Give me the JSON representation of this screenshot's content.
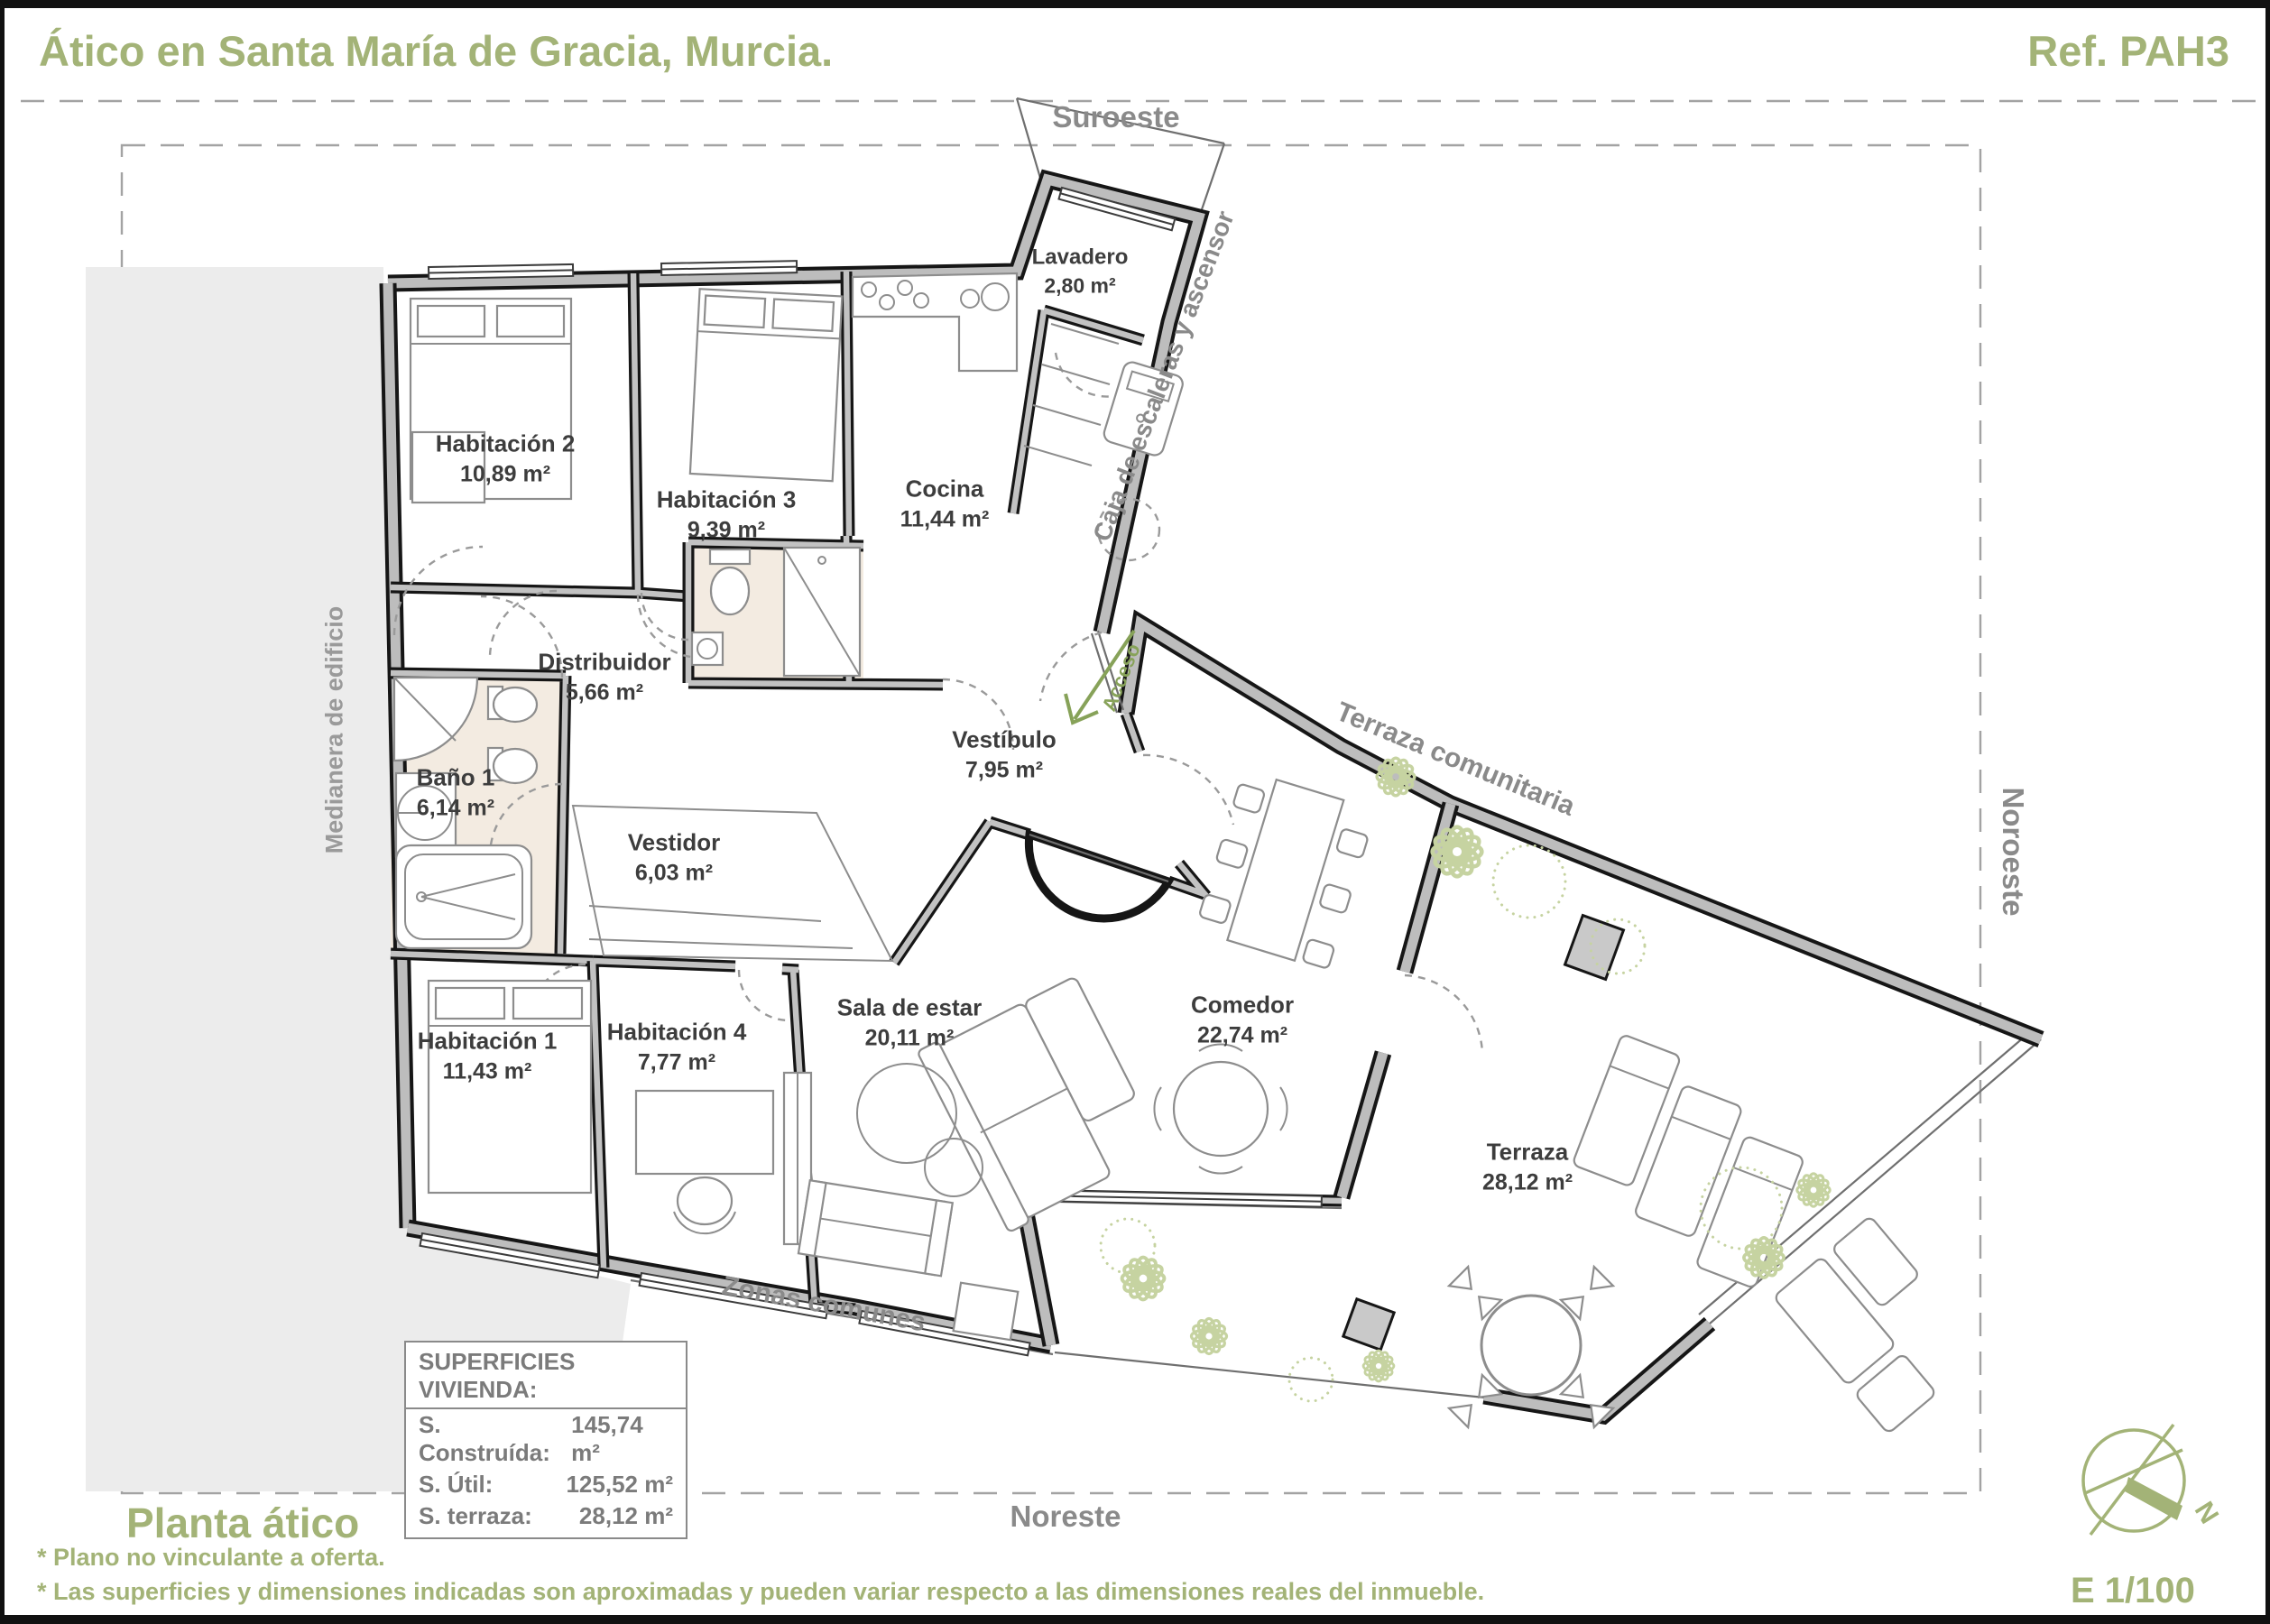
{
  "header": {
    "title": "Ático en Santa María de Gracia, Murcia.",
    "reference": "Ref. PAH3"
  },
  "orientation": {
    "top": "Suroeste",
    "bottom": "Noreste",
    "right": "Noroeste"
  },
  "rooms": {
    "habitacion_2": {
      "name": "Habitación 2",
      "area": "10,89 m²"
    },
    "habitacion_3": {
      "name": "Habitación 3",
      "area": "9,39 m²"
    },
    "cocina": {
      "name": "Cocina",
      "area": "11,44 m²"
    },
    "lavadero": {
      "name": "Lavadero",
      "area": "2,80 m²"
    },
    "distribuidor": {
      "name": "Distribuidor",
      "area": "5,66 m²"
    },
    "bano_1": {
      "name": "Baño 1",
      "area": "6,14 m²"
    },
    "vestidor": {
      "name": "Vestidor",
      "area": "6,03 m²"
    },
    "vestibulo": {
      "name": "Vestíbulo",
      "area": "7,95 m²"
    },
    "habitacion_1": {
      "name": "Habitación 1",
      "area": "11,43 m²"
    },
    "habitacion_4": {
      "name": "Habitación 4",
      "area": "7,77 m²"
    },
    "sala_de_estar": {
      "name": "Sala de estar",
      "area": "20,11 m²"
    },
    "comedor": {
      "name": "Comedor",
      "area": "22,74 m²"
    },
    "terraza": {
      "name": "Terraza",
      "area": "28,12 m²"
    }
  },
  "annotations": {
    "stairs": "Caja de escaleras y ascensor",
    "common_terrace": "Terraza comunitaria",
    "common_zones": "Zonas comunes",
    "access": "Acceso",
    "party_wall": "Medianera de edificio"
  },
  "areas_table": {
    "title": "SUPERFICIES VIVIENDA:",
    "rows": [
      {
        "label": "S. Construída:",
        "value": "145,74 m²"
      },
      {
        "label": "S. Útil:",
        "value": "125,52 m²"
      },
      {
        "label": "S. terraza:",
        "value": "28,12 m²"
      }
    ]
  },
  "footer": {
    "plan_name": "Planta ático",
    "notes": [
      "* Plano no vinculante a oferta.",
      "* Las superficies y dimensiones indicadas son aproximadas y pueden variar respecto a las dimensiones reales del inmueble."
    ],
    "scale": "E 1/100",
    "north_label": "N"
  },
  "colors": {
    "accent": "#a3b377",
    "muted_text": "#8a8a8a",
    "wall_fill": "#bdbdbd",
    "wall_edge": "#161616",
    "bath_floor": "#f3ebe1",
    "party_wall_fill": "#ececec",
    "plant": "#c6d3a1",
    "access_green": "#87a259"
  }
}
